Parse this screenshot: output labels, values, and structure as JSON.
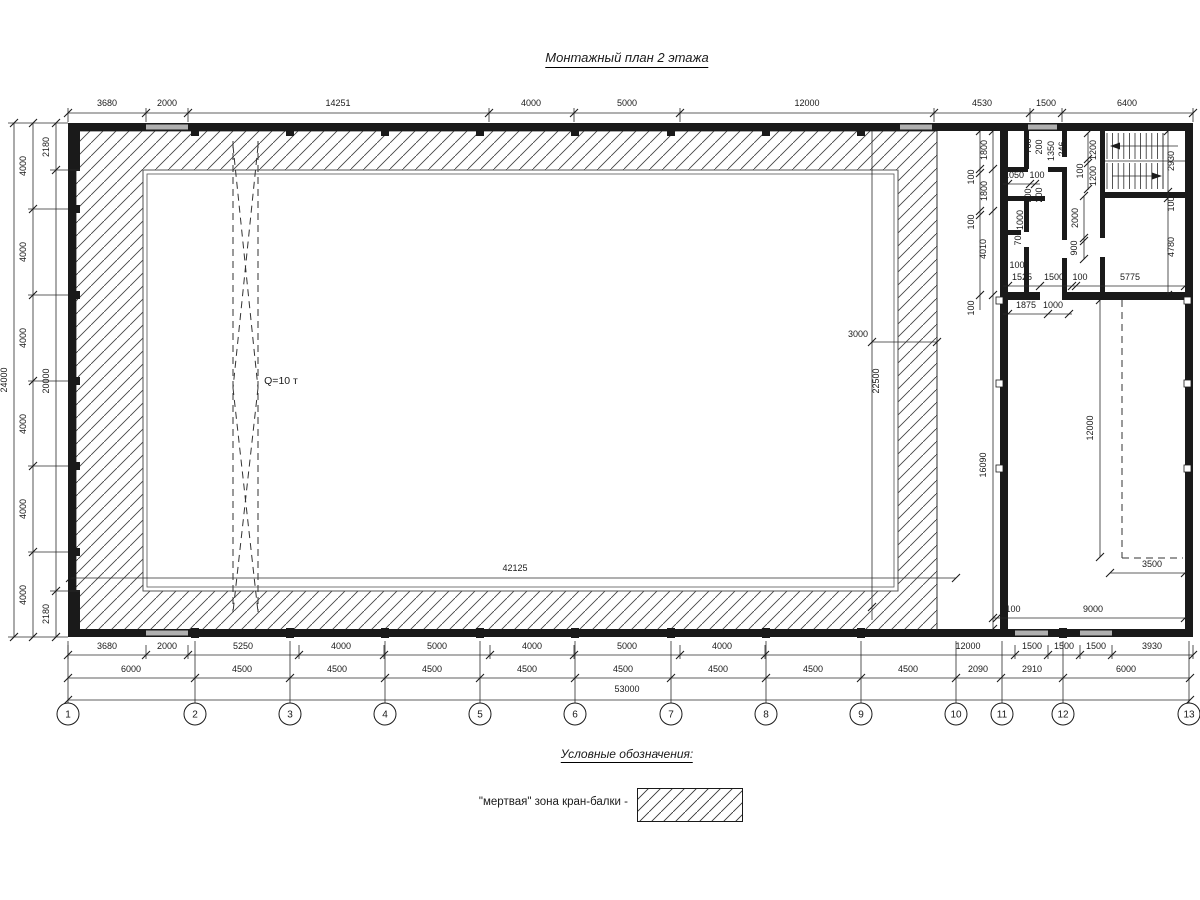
{
  "title": "Монтажный план 2 этажа",
  "legend": {
    "heading": "Условные обозначения:",
    "item_label": "\"мертвая\" зона кран-балки -"
  },
  "colors": {
    "line": "#1a1a1a",
    "opening": "#b0b0b0",
    "hatch": "#444444",
    "bg": "#ffffff"
  },
  "grid": {
    "y": 714,
    "r": 11,
    "items": [
      {
        "label": "1",
        "x": 68
      },
      {
        "label": "2",
        "x": 195
      },
      {
        "label": "3",
        "x": 290
      },
      {
        "label": "4",
        "x": 385
      },
      {
        "label": "5",
        "x": 480
      },
      {
        "label": "6",
        "x": 575
      },
      {
        "label": "7",
        "x": 671
      },
      {
        "label": "8",
        "x": 766
      },
      {
        "label": "9",
        "x": 861
      },
      {
        "label": "10",
        "x": 956
      },
      {
        "label": "11",
        "x": 1002
      },
      {
        "label": "12",
        "x": 1063
      },
      {
        "label": "13",
        "x": 1189
      }
    ]
  },
  "labels": [
    {
      "t": "3680",
      "x": 107,
      "y": 106
    },
    {
      "t": "2000",
      "x": 167,
      "y": 106
    },
    {
      "t": "14251",
      "x": 338,
      "y": 106
    },
    {
      "t": "4000",
      "x": 531,
      "y": 106
    },
    {
      "t": "5000",
      "x": 627,
      "y": 106
    },
    {
      "t": "12000",
      "x": 807,
      "y": 106
    },
    {
      "t": "4530",
      "x": 982,
      "y": 106
    },
    {
      "t": "1500",
      "x": 1046,
      "y": 106
    },
    {
      "t": "6400",
      "x": 1127,
      "y": 106
    },
    {
      "t": "3680",
      "x": 107,
      "y": 649
    },
    {
      "t": "2000",
      "x": 167,
      "y": 649
    },
    {
      "t": "5250",
      "x": 243,
      "y": 649
    },
    {
      "t": "4000",
      "x": 341,
      "y": 649
    },
    {
      "t": "5000",
      "x": 437,
      "y": 649
    },
    {
      "t": "4000",
      "x": 532,
      "y": 649
    },
    {
      "t": "5000",
      "x": 627,
      "y": 649
    },
    {
      "t": "4000",
      "x": 722,
      "y": 649
    },
    {
      "t": "12000",
      "x": 968,
      "y": 649
    },
    {
      "t": "1500",
      "x": 1032,
      "y": 649
    },
    {
      "t": "1500",
      "x": 1064,
      "y": 649
    },
    {
      "t": "1500",
      "x": 1096,
      "y": 649
    },
    {
      "t": "3930",
      "x": 1152,
      "y": 649
    },
    {
      "t": "6000",
      "x": 131,
      "y": 672
    },
    {
      "t": "4500",
      "x": 242,
      "y": 672
    },
    {
      "t": "4500",
      "x": 337,
      "y": 672
    },
    {
      "t": "4500",
      "x": 432,
      "y": 672
    },
    {
      "t": "4500",
      "x": 527,
      "y": 672
    },
    {
      "t": "4500",
      "x": 623,
      "y": 672
    },
    {
      "t": "4500",
      "x": 718,
      "y": 672
    },
    {
      "t": "4500",
      "x": 813,
      "y": 672
    },
    {
      "t": "4500",
      "x": 908,
      "y": 672
    },
    {
      "t": "2090",
      "x": 978,
      "y": 672
    },
    {
      "t": "2910",
      "x": 1032,
      "y": 672
    },
    {
      "t": "6000",
      "x": 1126,
      "y": 672
    },
    {
      "t": "53000",
      "x": 627,
      "y": 692
    },
    {
      "t": "24000",
      "x": 7,
      "y": 380,
      "r": 1
    },
    {
      "t": "4000",
      "x": 26,
      "y": 166,
      "r": 1
    },
    {
      "t": "4000",
      "x": 26,
      "y": 252,
      "r": 1
    },
    {
      "t": "4000",
      "x": 26,
      "y": 338,
      "r": 1
    },
    {
      "t": "4000",
      "x": 26,
      "y": 424,
      "r": 1
    },
    {
      "t": "4000",
      "x": 26,
      "y": 509,
      "r": 1
    },
    {
      "t": "4000",
      "x": 26,
      "y": 595,
      "r": 1
    },
    {
      "t": "2180",
      "x": 49,
      "y": 147,
      "r": 1
    },
    {
      "t": "20000",
      "x": 49,
      "y": 381,
      "r": 1
    },
    {
      "t": "2180",
      "x": 49,
      "y": 614,
      "r": 1
    },
    {
      "t": "Q=10 т",
      "x": 281,
      "y": 384,
      "fs": 10.5
    },
    {
      "t": "3000",
      "x": 858,
      "y": 337
    },
    {
      "t": "22500",
      "x": 879,
      "y": 381,
      "r": 1
    },
    {
      "t": "42125",
      "x": 515,
      "y": 571
    },
    {
      "t": "1800",
      "x": 987,
      "y": 150,
      "r": 1
    },
    {
      "t": "100",
      "x": 974,
      "y": 177,
      "r": 1
    },
    {
      "t": "1800",
      "x": 987,
      "y": 191,
      "r": 1
    },
    {
      "t": "100",
      "x": 974,
      "y": 222,
      "r": 1
    },
    {
      "t": "4010",
      "x": 986,
      "y": 249,
      "r": 1
    },
    {
      "t": "100",
      "x": 974,
      "y": 308,
      "r": 1
    },
    {
      "t": "16090",
      "x": 986,
      "y": 465,
      "r": 1
    },
    {
      "t": "700",
      "x": 1031,
      "y": 146,
      "r": 1
    },
    {
      "t": "200",
      "x": 1042,
      "y": 147,
      "r": 1
    },
    {
      "t": "1350",
      "x": 1054,
      "y": 151,
      "r": 1
    },
    {
      "t": "246",
      "x": 1065,
      "y": 149,
      "r": 1
    },
    {
      "t": "1200",
      "x": 1096,
      "y": 150,
      "r": 1
    },
    {
      "t": "100",
      "x": 1083,
      "y": 171,
      "r": 1
    },
    {
      "t": "1200",
      "x": 1096,
      "y": 176,
      "r": 1
    },
    {
      "t": "700",
      "x": 1031,
      "y": 196,
      "r": 1
    },
    {
      "t": "200",
      "x": 1042,
      "y": 195,
      "r": 1
    },
    {
      "t": "1000",
      "x": 1023,
      "y": 220,
      "r": 1
    },
    {
      "t": "700",
      "x": 1021,
      "y": 238,
      "r": 1
    },
    {
      "t": "2000",
      "x": 1078,
      "y": 218,
      "r": 1
    },
    {
      "t": "900",
      "x": 1077,
      "y": 248,
      "r": 1
    },
    {
      "t": "2930",
      "x": 1174,
      "y": 161,
      "r": 1
    },
    {
      "t": "100",
      "x": 1174,
      "y": 204,
      "r": 1
    },
    {
      "t": "4780",
      "x": 1174,
      "y": 247,
      "r": 1
    },
    {
      "t": "12000",
      "x": 1093,
      "y": 428,
      "r": 1
    },
    {
      "t": "1050",
      "x": 1014,
      "y": 178
    },
    {
      "t": "100",
      "x": 1037,
      "y": 178
    },
    {
      "t": "100",
      "x": 1017,
      "y": 268
    },
    {
      "t": "1525",
      "x": 1022,
      "y": 280
    },
    {
      "t": "1500",
      "x": 1054,
      "y": 280
    },
    {
      "t": "100",
      "x": 1080,
      "y": 280
    },
    {
      "t": "5775",
      "x": 1130,
      "y": 280
    },
    {
      "t": "1875",
      "x": 1026,
      "y": 308
    },
    {
      "t": "1000",
      "x": 1053,
      "y": 308
    },
    {
      "t": "100",
      "x": 1013,
      "y": 612
    },
    {
      "t": "9000",
      "x": 1093,
      "y": 612
    },
    {
      "t": "3500",
      "x": 1152,
      "y": 567
    }
  ],
  "drawing": {
    "hatch_path": "M76,131H937V630H76Z M143,170H898V591H143Z",
    "walls": [
      [
        68,
        123,
        1125,
        8
      ],
      [
        68,
        629,
        1125,
        8
      ],
      [
        68,
        123,
        8,
        514
      ],
      [
        1185,
        123,
        8,
        514
      ],
      [
        1000,
        123,
        8,
        514
      ],
      [
        1000,
        292,
        193,
        8
      ],
      [
        68,
        123,
        12,
        48
      ],
      [
        68,
        590,
        12,
        47
      ],
      [
        1003,
        167,
        25,
        5
      ],
      [
        1048,
        167,
        19,
        5
      ],
      [
        1024,
        129,
        5,
        40
      ],
      [
        1003,
        196,
        42,
        5
      ],
      [
        1062,
        131,
        5,
        26
      ],
      [
        1062,
        170,
        5,
        70
      ],
      [
        1062,
        258,
        5,
        36
      ],
      [
        1024,
        201,
        5,
        31
      ],
      [
        1024,
        247,
        5,
        45
      ],
      [
        1003,
        230,
        18,
        5
      ],
      [
        1100,
        131,
        5,
        65
      ],
      [
        1100,
        196,
        5,
        42
      ],
      [
        1100,
        257,
        5,
        35
      ],
      [
        1100,
        192,
        87,
        6
      ]
    ],
    "gray_segments": [
      [
        146,
        124.5,
        42,
        5
      ],
      [
        900,
        124.5,
        32,
        5
      ],
      [
        1028,
        124.5,
        29,
        5
      ],
      [
        146,
        630.5,
        42,
        5
      ],
      [
        1015,
        630.5,
        33,
        5
      ],
      [
        1080,
        630.5,
        32,
        5
      ]
    ],
    "white_gaps": [
      [
        1040,
        292,
        22,
        8
      ]
    ],
    "rects_outline": [
      [
        143,
        170,
        755,
        421
      ],
      [
        147,
        174,
        747,
        413
      ]
    ],
    "thin_lines": [
      [
        68,
        113,
        1193,
        113
      ],
      [
        68,
        655,
        1193,
        655
      ],
      [
        68,
        678,
        1190,
        678
      ],
      [
        68,
        700,
        1190,
        700
      ],
      [
        14,
        123,
        14,
        637
      ],
      [
        33,
        123,
        33,
        637
      ],
      [
        56,
        123,
        56,
        637
      ],
      [
        8,
        123,
        68,
        123
      ],
      [
        8,
        637,
        68,
        637
      ],
      [
        28,
        209,
        68,
        209
      ],
      [
        28,
        295,
        68,
        295
      ],
      [
        28,
        381,
        68,
        381
      ],
      [
        28,
        466,
        68,
        466
      ],
      [
        28,
        552,
        68,
        552
      ],
      [
        50,
        170,
        80,
        170
      ],
      [
        50,
        591,
        80,
        591
      ],
      [
        937,
        131,
        937,
        630
      ],
      [
        872,
        131,
        872,
        620
      ],
      [
        872,
        342,
        937,
        342
      ],
      [
        70,
        578,
        956,
        578
      ],
      [
        1100,
        300,
        1100,
        557
      ],
      [
        993,
        131,
        993,
        629
      ],
      [
        980,
        131,
        980,
        310
      ],
      [
        1088,
        133,
        1088,
        190
      ],
      [
        1168,
        131,
        1168,
        295
      ],
      [
        1003,
        184,
        1040,
        184
      ],
      [
        1084,
        196,
        1084,
        259
      ],
      [
        1003,
        286,
        1185,
        286
      ],
      [
        1003,
        314,
        1072,
        314
      ],
      [
        993,
        618,
        1185,
        618
      ],
      [
        1110,
        573,
        1185,
        573
      ],
      [
        1105,
        161,
        1185,
        161
      ],
      [
        1163,
        133,
        1163,
        189
      ],
      [
        1178,
        146,
        1112,
        146
      ],
      [
        1112,
        176,
        1160,
        176
      ]
    ],
    "ext_ticks_top": [
      68,
      146,
      188,
      489,
      574,
      680,
      934,
      1030,
      1062,
      1193
    ],
    "ext_ticks_row1": [
      68,
      146,
      188,
      299,
      384,
      490,
      574,
      680,
      765,
      1015,
      1048,
      1080,
      1112,
      1193
    ],
    "ticks": [
      [
        68,
        113
      ],
      [
        146,
        113
      ],
      [
        188,
        113
      ],
      [
        489,
        113
      ],
      [
        574,
        113
      ],
      [
        680,
        113
      ],
      [
        934,
        113
      ],
      [
        1030,
        113
      ],
      [
        1062,
        113
      ],
      [
        1193,
        113
      ],
      [
        68,
        655
      ],
      [
        146,
        655
      ],
      [
        188,
        655
      ],
      [
        299,
        655
      ],
      [
        384,
        655
      ],
      [
        490,
        655
      ],
      [
        574,
        655
      ],
      [
        680,
        655
      ],
      [
        765,
        655
      ],
      [
        1015,
        655
      ],
      [
        1048,
        655
      ],
      [
        1080,
        655
      ],
      [
        1112,
        655
      ],
      [
        1193,
        655
      ],
      [
        68,
        678
      ],
      [
        195,
        678
      ],
      [
        290,
        678
      ],
      [
        385,
        678
      ],
      [
        480,
        678
      ],
      [
        575,
        678
      ],
      [
        671,
        678
      ],
      [
        766,
        678
      ],
      [
        861,
        678
      ],
      [
        956,
        678
      ],
      [
        1001,
        678
      ],
      [
        1063,
        678
      ],
      [
        1190,
        678
      ],
      [
        68,
        700
      ],
      [
        1190,
        700
      ],
      [
        14,
        123
      ],
      [
        14,
        637
      ],
      [
        33,
        123
      ],
      [
        33,
        209
      ],
      [
        33,
        295
      ],
      [
        33,
        381
      ],
      [
        33,
        466
      ],
      [
        33,
        552
      ],
      [
        33,
        637
      ],
      [
        56,
        123
      ],
      [
        56,
        170
      ],
      [
        56,
        591
      ],
      [
        56,
        637
      ],
      [
        872,
        342
      ],
      [
        937,
        342
      ],
      [
        872,
        607
      ],
      [
        70,
        578
      ],
      [
        956,
        578
      ],
      [
        1100,
        300
      ],
      [
        1100,
        557
      ],
      [
        993,
        131
      ],
      [
        993,
        169
      ],
      [
        993,
        211
      ],
      [
        993,
        295
      ],
      [
        993,
        629
      ],
      [
        980,
        131
      ],
      [
        980,
        169
      ],
      [
        980,
        173
      ],
      [
        980,
        211
      ],
      [
        980,
        215
      ],
      [
        980,
        295
      ],
      [
        1088,
        133
      ],
      [
        1088,
        159
      ],
      [
        1088,
        163
      ],
      [
        1088,
        189
      ],
      [
        1168,
        131
      ],
      [
        1168,
        192
      ],
      [
        1168,
        198
      ],
      [
        1168,
        295
      ],
      [
        1008,
        184
      ],
      [
        1030,
        184
      ],
      [
        1035,
        184
      ],
      [
        1084,
        196
      ],
      [
        1084,
        238
      ],
      [
        1084,
        241
      ],
      [
        1084,
        259
      ],
      [
        1008,
        286
      ],
      [
        1040,
        286
      ],
      [
        1072,
        286
      ],
      [
        1076,
        286
      ],
      [
        1185,
        286
      ],
      [
        1008,
        314
      ],
      [
        1048,
        314
      ],
      [
        1069,
        314
      ],
      [
        993,
        618
      ],
      [
        997,
        618
      ],
      [
        1185,
        618
      ],
      [
        1110,
        573
      ],
      [
        1185,
        573
      ]
    ],
    "dashed_lines": [
      [
        233,
        141,
        233,
        612
      ],
      [
        258,
        141,
        258,
        612
      ],
      [
        233,
        146,
        258,
        388
      ],
      [
        258,
        146,
        233,
        388
      ],
      [
        233,
        388,
        258,
        612
      ],
      [
        258,
        388,
        233,
        612
      ],
      [
        1122,
        300,
        1122,
        558
      ],
      [
        1122,
        558,
        1183,
        558
      ]
    ],
    "squares_black_top_x": [
      195,
      290,
      385,
      480,
      575,
      671,
      766,
      861
    ],
    "squares_black_bottom_x": [
      195,
      290,
      385,
      480,
      575,
      671,
      766,
      861,
      1063
    ],
    "squares_black_left_y": [
      209,
      295,
      381,
      466,
      552
    ],
    "squares_white": [
      [
        996,
        297,
        7,
        7
      ],
      [
        996,
        380,
        7,
        7
      ],
      [
        996,
        465,
        7,
        7
      ],
      [
        1184,
        297,
        7,
        7
      ],
      [
        1184,
        380,
        7,
        7
      ],
      [
        1184,
        465,
        7,
        7
      ]
    ],
    "polys": [
      [
        [
          1110,
          146
        ],
        [
          1120,
          142.5
        ],
        [
          1120,
          149.5
        ]
      ],
      [
        [
          1162,
          176
        ],
        [
          1152,
          172.5
        ],
        [
          1152,
          179.5
        ]
      ]
    ],
    "stairs": {
      "x1": 1107,
      "x2": 1163,
      "n": 11,
      "top": [
        133,
        159
      ],
      "bot": [
        163,
        189
      ]
    },
    "axis_line_y": [
      641,
      703
    ]
  }
}
